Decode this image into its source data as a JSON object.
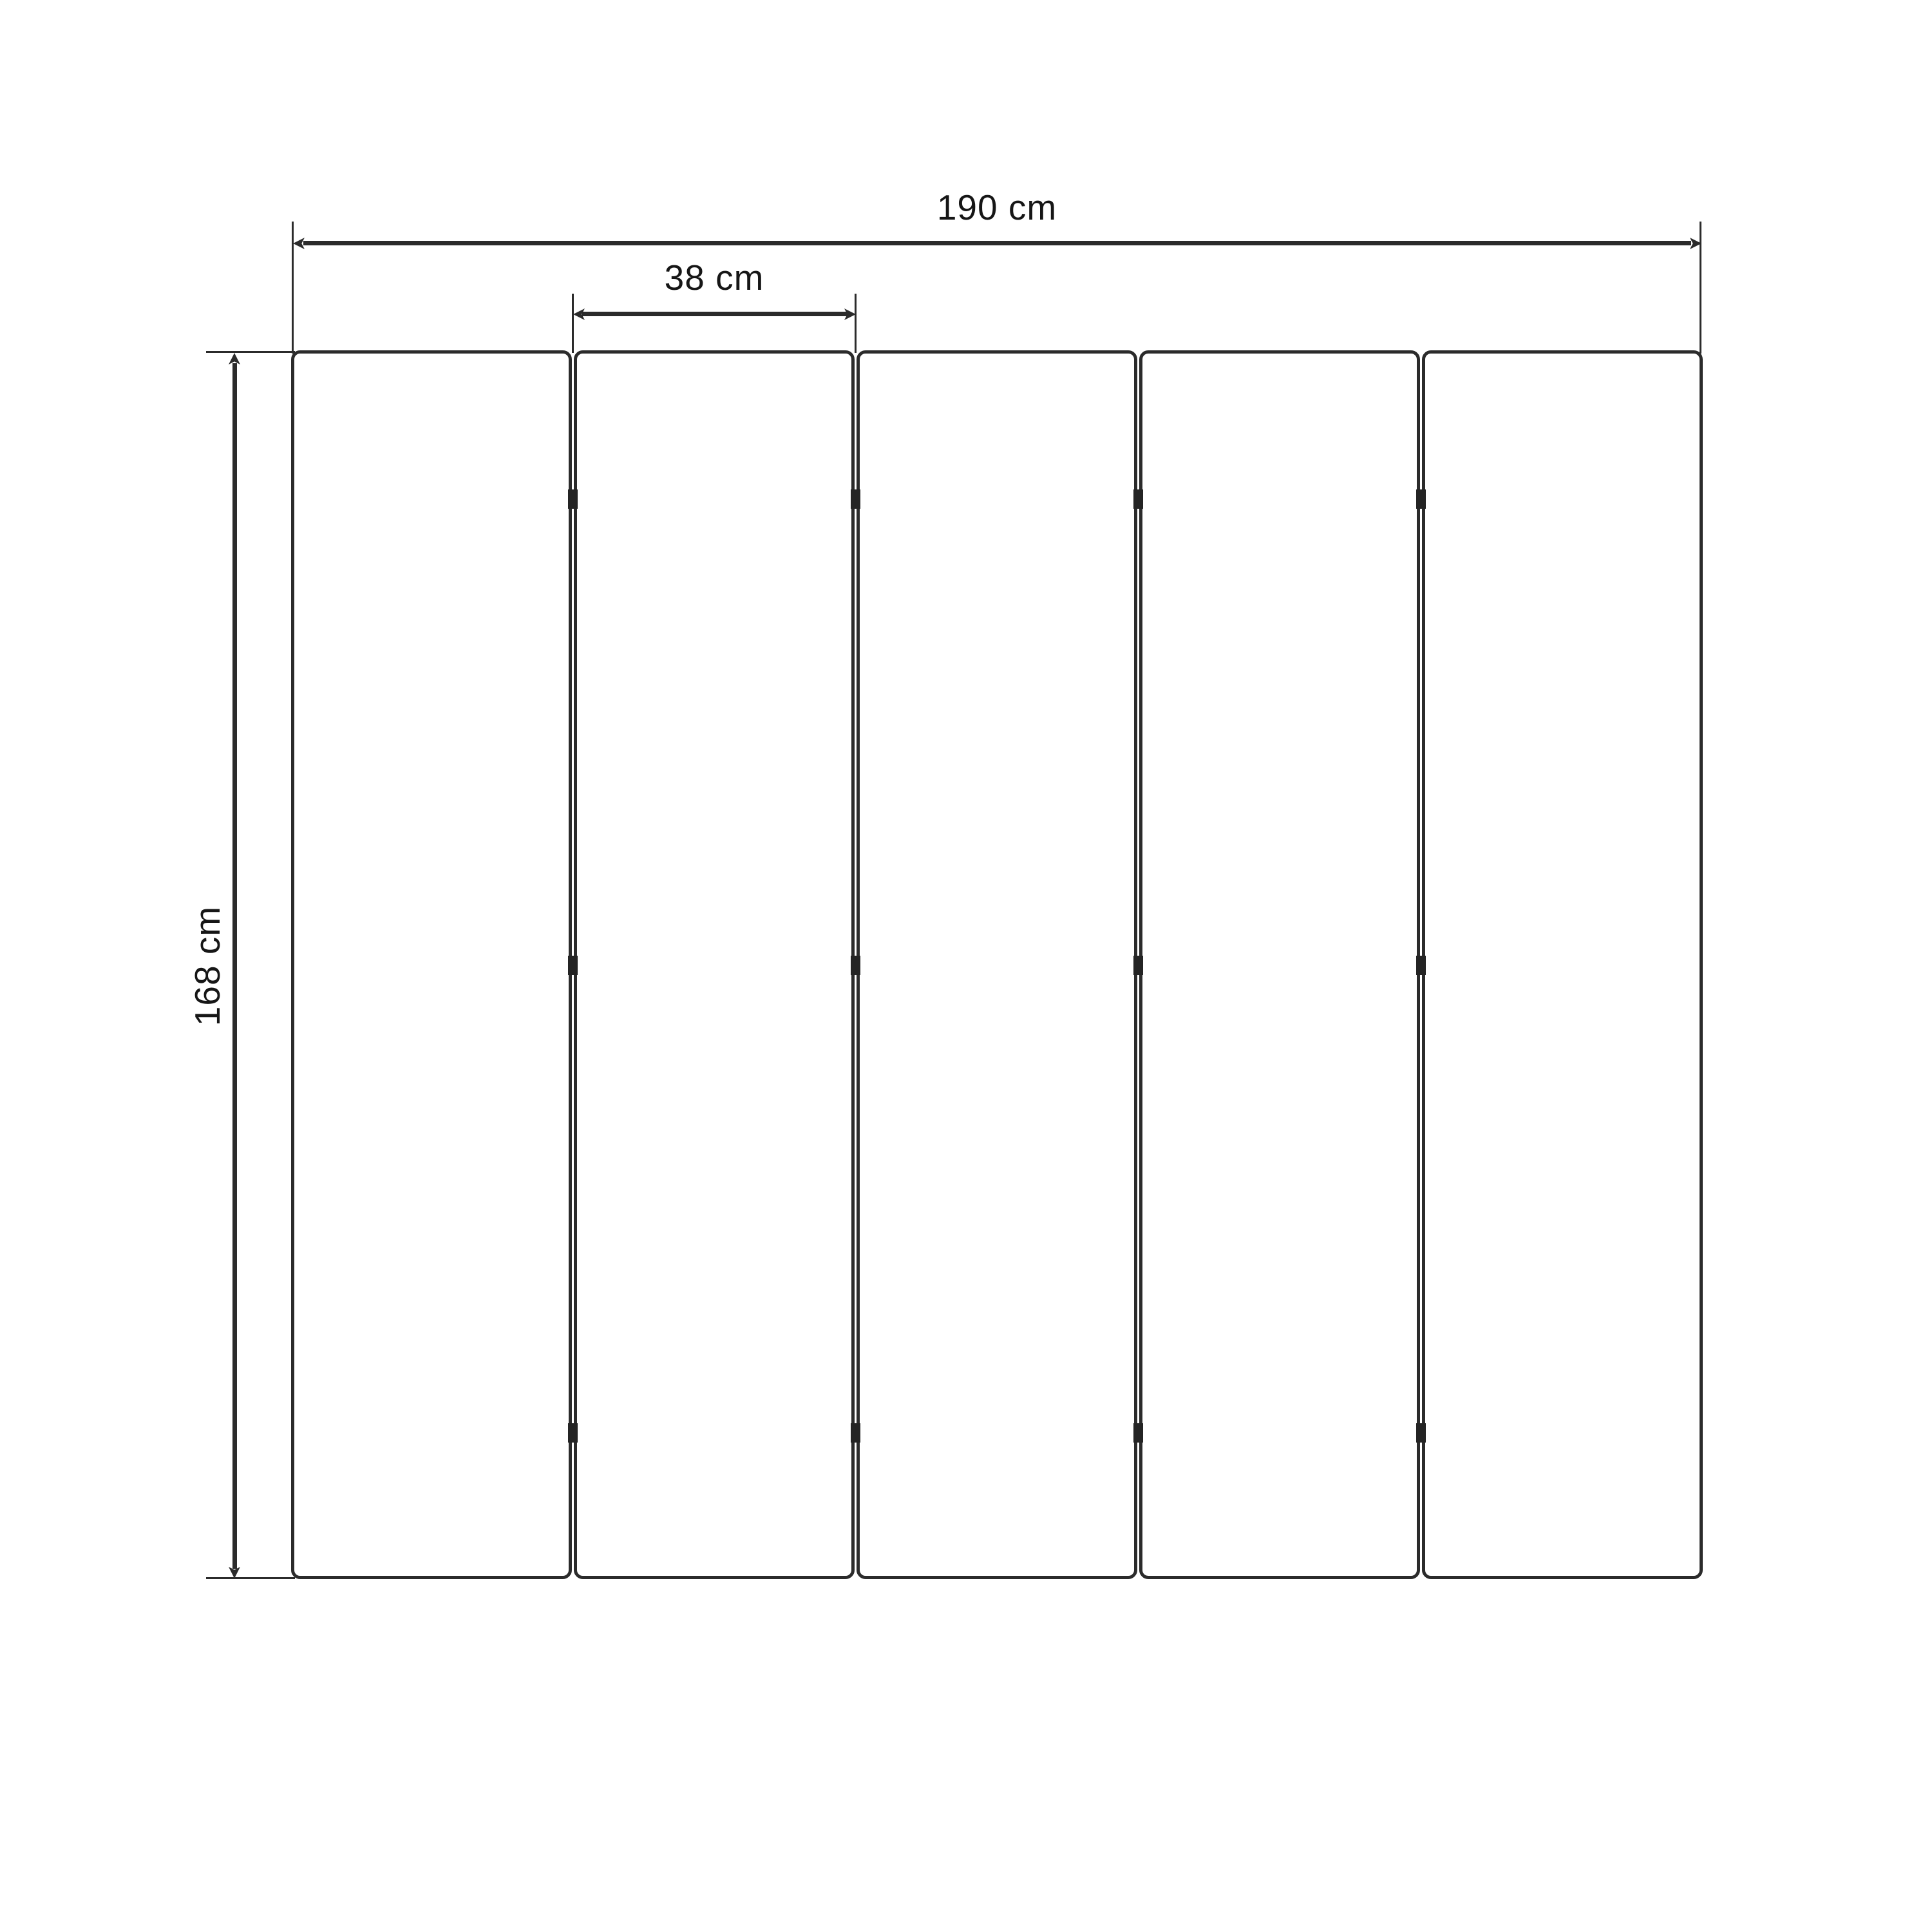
{
  "diagram": {
    "labels": {
      "total_width": "190 cm",
      "panel_width": "38 cm",
      "height": "168 cm"
    },
    "panel_count": 5,
    "gap_count": 4,
    "hinges_per_gap": 3,
    "colors": {
      "line": "#2b2b2b",
      "text": "#161616",
      "background": "#ffffff"
    }
  }
}
